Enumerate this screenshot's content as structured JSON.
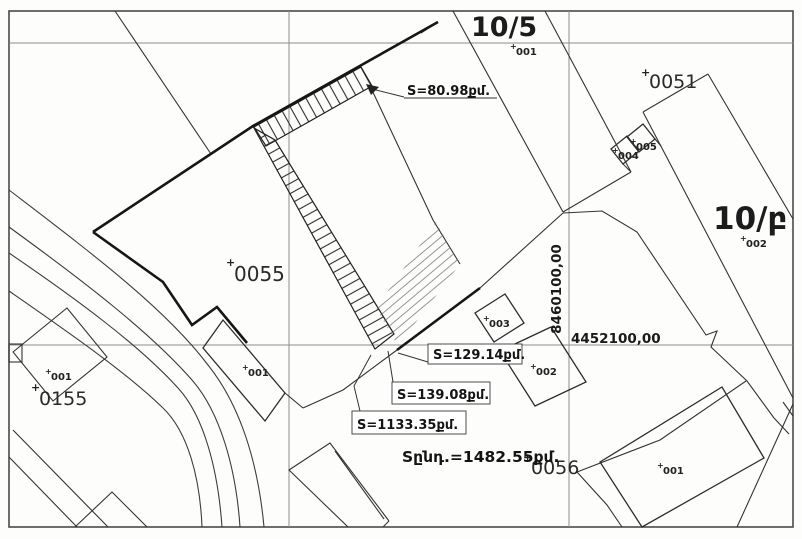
{
  "map": {
    "marker": "+",
    "zones": {
      "top": "10/5",
      "right": "10/բ"
    },
    "parcels": {
      "p0051": "0051",
      "p0055": "0055",
      "p0155": "0155",
      "p0056": "0056"
    },
    "points": {
      "n001": "001",
      "n002": "002",
      "n003": "003",
      "n004": "004",
      "n005": "005"
    },
    "areas": {
      "band_top": "S=80.98քմ.",
      "wedge": "S=129.14քմ.",
      "band_long": "S=139.08քմ.",
      "main": "S=1133.35քմ.",
      "total": "Sընդ.=1482.55քմ."
    },
    "grid": {
      "vline_label": "8460100,00",
      "hline_label": "4452100,00"
    }
  }
}
